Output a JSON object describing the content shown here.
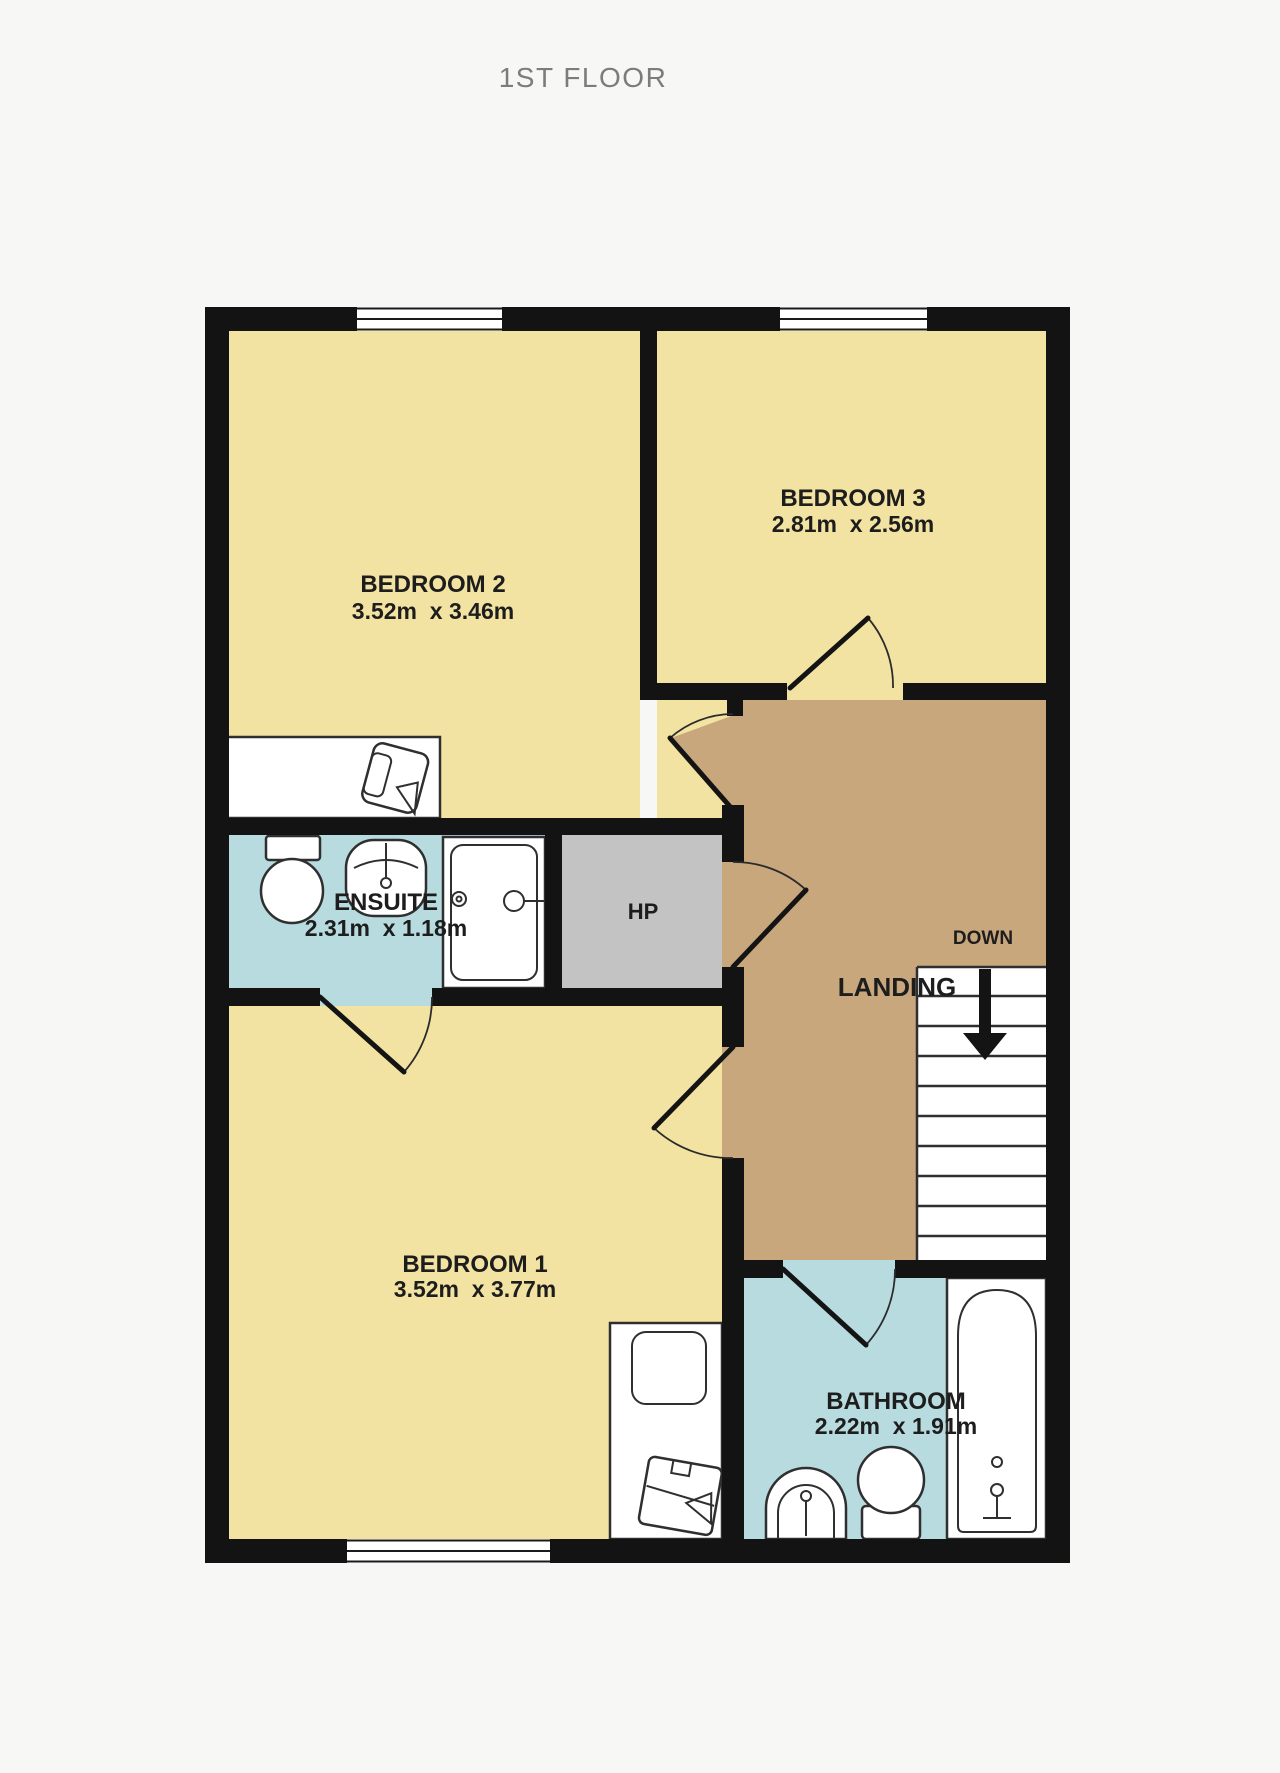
{
  "title": "1ST FLOOR",
  "rooms": {
    "bedroom2": {
      "name": "BEDROOM 2",
      "dims": "3.52m  x 3.46m"
    },
    "bedroom3": {
      "name": "BEDROOM 3",
      "dims": "2.81m  x 2.56m"
    },
    "ensuite": {
      "name": "ENSUITE",
      "dims": "2.31m  x 1.18m"
    },
    "hp": {
      "name": "HP"
    },
    "landing": {
      "name": "LANDING"
    },
    "bedroom1": {
      "name": "BEDROOM 1",
      "dims": "3.52m  x 3.77m"
    },
    "bathroom": {
      "name": "BATHROOM",
      "dims": "2.22m  x 1.91m"
    }
  },
  "stairs": {
    "label": "DOWN",
    "direction": "down",
    "tread_count": 9
  },
  "fixtures": {
    "bedroom2": [
      "desk",
      "chair"
    ],
    "ensuite": [
      "toilet",
      "sink",
      "shower"
    ],
    "bedroom1": [
      "bed",
      "pillow",
      "blanket-chest"
    ],
    "bathroom": [
      "pedestal-sink",
      "toilet",
      "bathtub"
    ]
  },
  "windows": {
    "top_wall": 2,
    "bottom_wall": 1
  },
  "colors": {
    "background": "#F7F7F6",
    "room_yellow": "#F3E3A2",
    "wet_room_blue": "#B7DBDF",
    "landing_brown": "#C8A77C",
    "hp_gray": "#C3C3C3",
    "wall_black": "#131313",
    "title_gray": "#7C7C7C"
  }
}
